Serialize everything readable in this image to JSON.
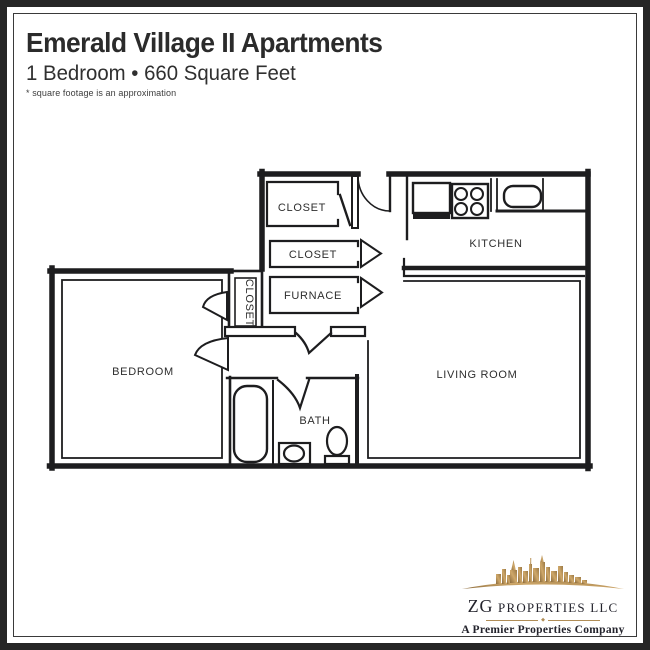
{
  "page": {
    "background": "#ffffff",
    "border_color": "#262626",
    "inner_rule_color": "#3a3a3a"
  },
  "header": {
    "title": "Emerald Village II Apartments",
    "subtitle": "1 Bedroom • 660 Square Feet",
    "note": "* square footage is an approximation"
  },
  "floorplan": {
    "wall_color": "#1d1d1f",
    "rooms": {
      "closet_top": "CLOSET",
      "closet_middle": "CLOSET",
      "furnace": "FURNACE",
      "kitchen": "KITCHEN",
      "bedroom_closet": "CLOSET",
      "bedroom": "BEDROOM",
      "living_room": "LIVING ROOM",
      "bath": "BATH"
    },
    "fixtures": {
      "kitchen": [
        "refrigerator",
        "stove",
        "sink"
      ],
      "bath": [
        "bathtub",
        "sink",
        "toilet"
      ]
    }
  },
  "logo": {
    "name_zg": "ZG",
    "name_rest": "PROPERTIES LLC",
    "tagline": "A Premier Properties Company",
    "gold_dark": "#8a6a3c",
    "gold_light": "#cfa86a",
    "text_color": "#23232c"
  }
}
